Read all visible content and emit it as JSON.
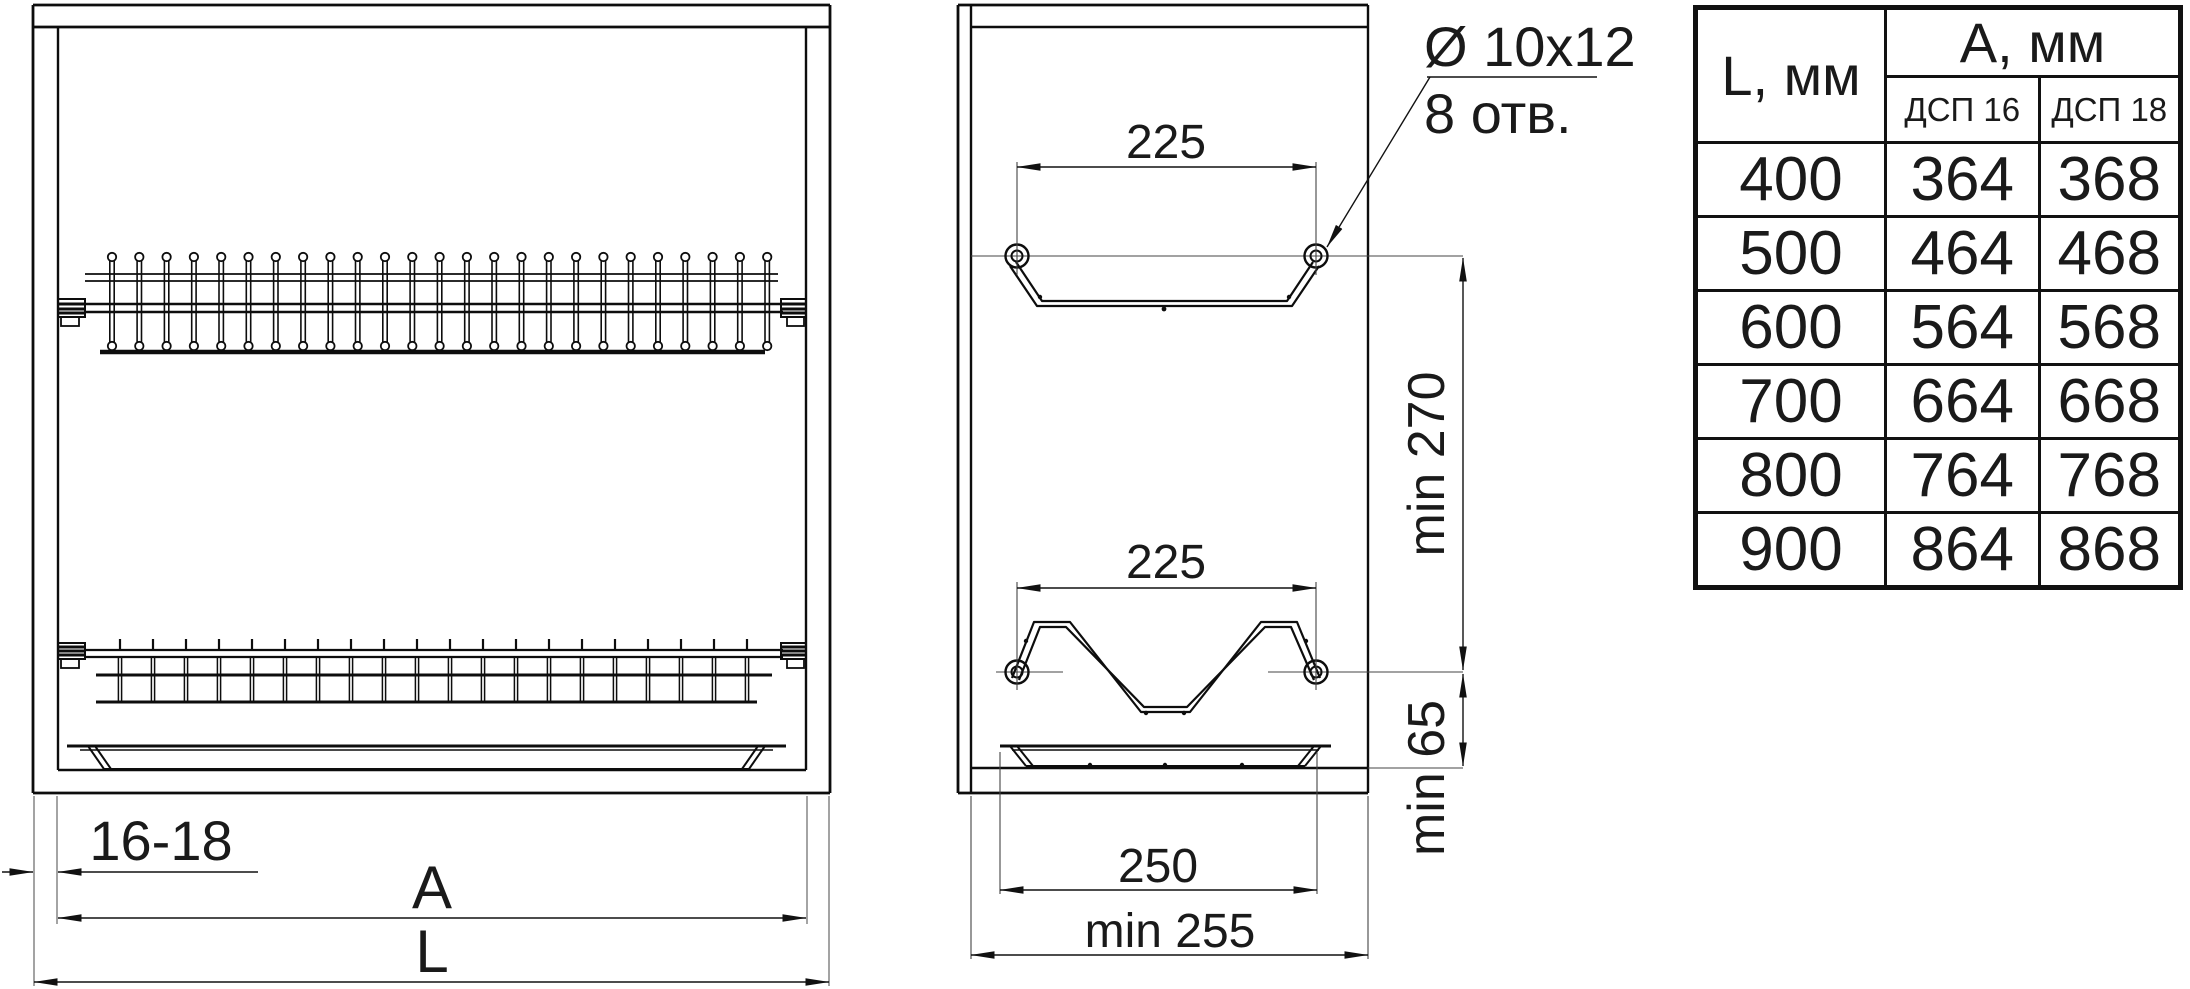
{
  "colors": {
    "line": "#111111",
    "background": "#ffffff"
  },
  "front_view": {
    "panel_thickness_dim": "16-18",
    "inner_width_dim": "A",
    "outer_width_dim": "L"
  },
  "side_view": {
    "upper_rack_hole_span_dim": "225",
    "lower_rack_hole_span_dim": "225",
    "rack_vertical_clearance_dim": "min 270",
    "lower_rack_bottom_clearance_dim": "min 65",
    "tray_width_dim": "250",
    "min_depth_dim": "min 255",
    "holes_spec": "Ø 10x12",
    "holes_count": "8 отв."
  },
  "table": {
    "l_header": "L, мм",
    "a_header": "A, мм",
    "sub_header_16": "ДСП 16",
    "sub_header_18": "ДСП 18",
    "rows": [
      {
        "l": "400",
        "dsp16": "364",
        "dsp18": "368"
      },
      {
        "l": "500",
        "dsp16": "464",
        "dsp18": "468"
      },
      {
        "l": "600",
        "dsp16": "564",
        "dsp18": "568"
      },
      {
        "l": "700",
        "dsp16": "664",
        "dsp18": "668"
      },
      {
        "l": "800",
        "dsp16": "764",
        "dsp18": "768"
      },
      {
        "l": "900",
        "dsp16": "864",
        "dsp18": "868"
      }
    ]
  }
}
